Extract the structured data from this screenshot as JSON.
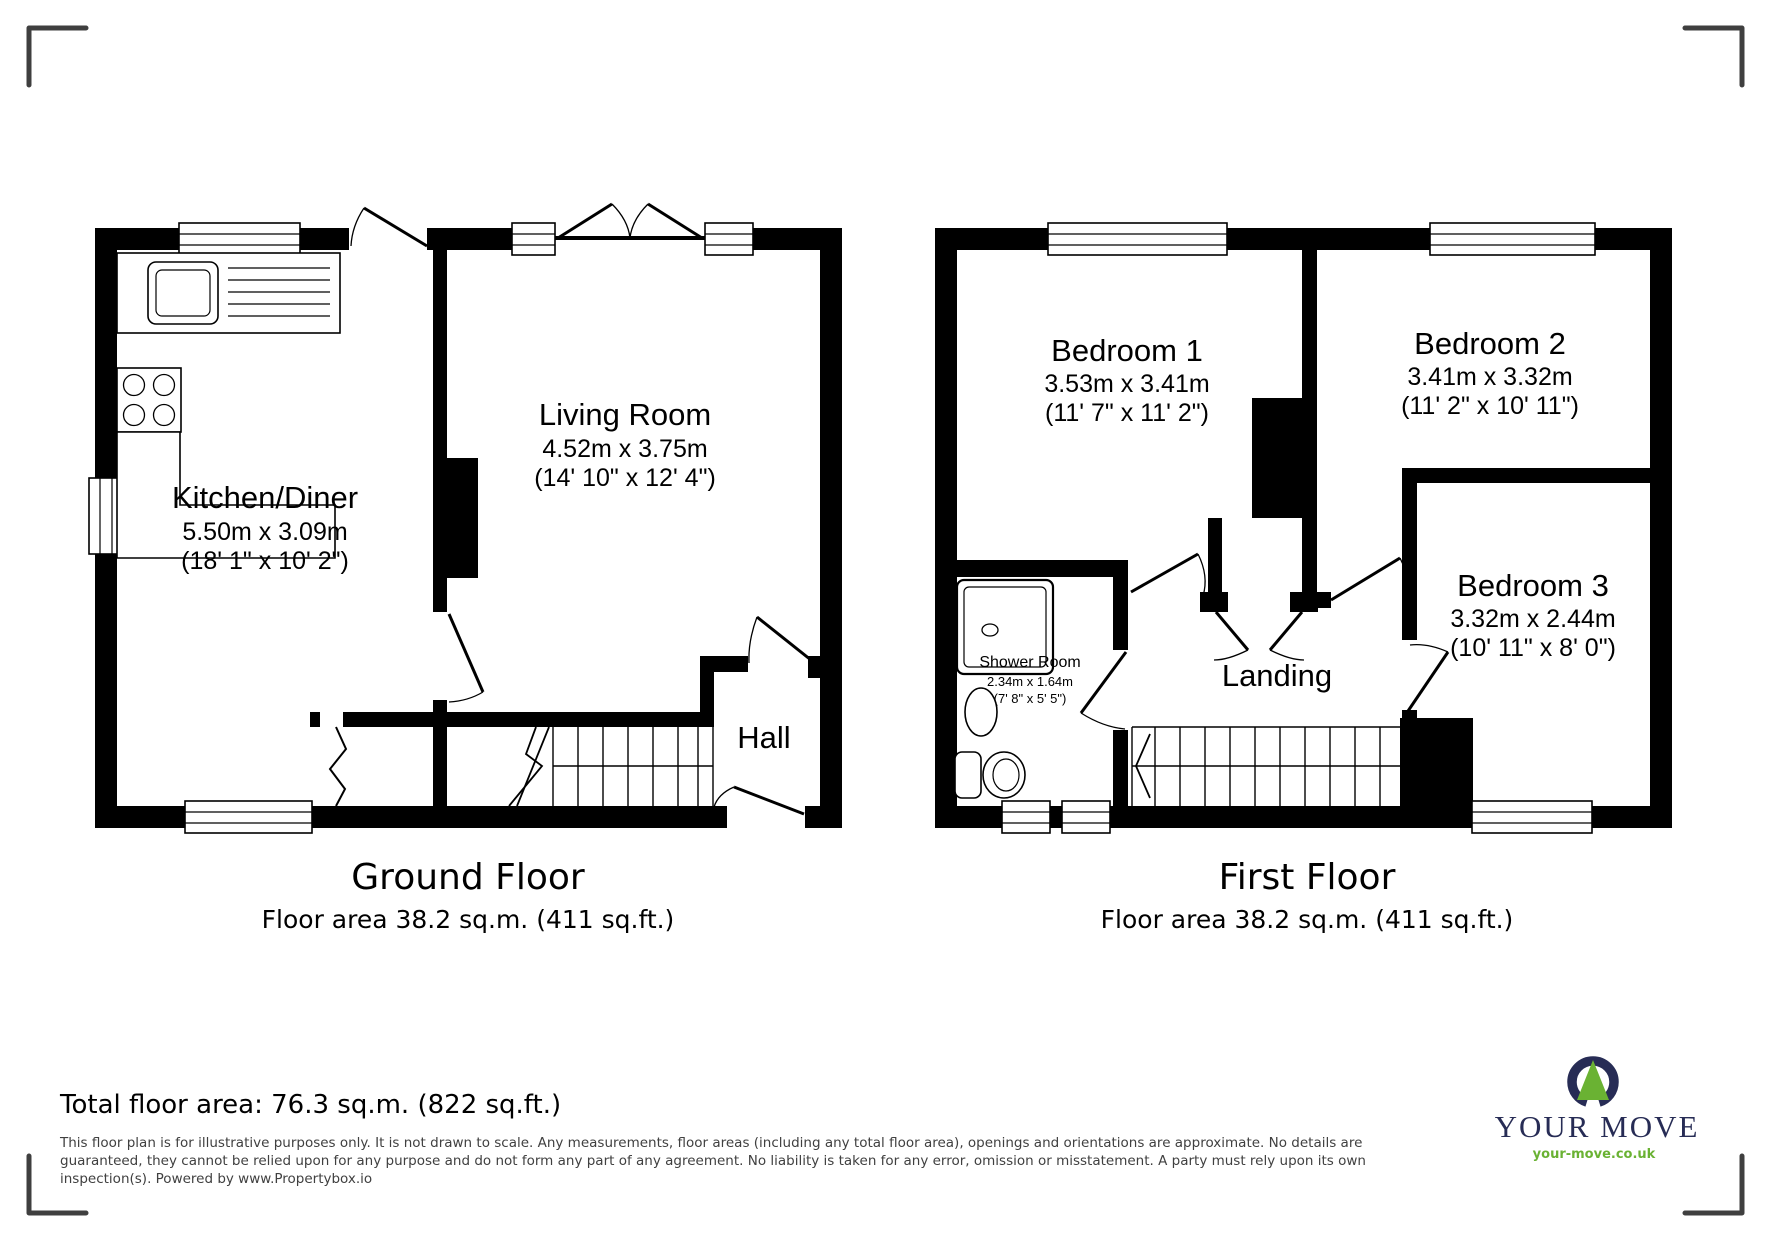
{
  "ground_floor": {
    "title": "Ground Floor",
    "area": "Floor area 38.2 sq.m. (411 sq.ft.)",
    "rooms": {
      "kitchen": {
        "name": "Kitchen/Diner",
        "metric": "5.50m x 3.09m",
        "imperial": "(18' 1\" x 10' 2\")"
      },
      "living": {
        "name": "Living Room",
        "metric": "4.52m x 3.75m",
        "imperial": "(14' 10\" x 12' 4\")"
      },
      "hall": {
        "name": "Hall"
      }
    }
  },
  "first_floor": {
    "title": "First Floor",
    "area": "Floor area 38.2 sq.m. (411 sq.ft.)",
    "rooms": {
      "bedroom1": {
        "name": "Bedroom 1",
        "metric": "3.53m x 3.41m",
        "imperial": "(11' 7\" x 11' 2\")"
      },
      "bedroom2": {
        "name": "Bedroom 2",
        "metric": "3.41m x 3.32m",
        "imperial": "(11' 2\" x 10' 11\")"
      },
      "bedroom3": {
        "name": "Bedroom 3",
        "metric": "3.32m x 2.44m",
        "imperial": "(10' 11\" x 8' 0\")"
      },
      "shower": {
        "name": "Shower Room",
        "metric": "2.34m x 1.64m",
        "imperial": "(7' 8\" x 5' 5\")"
      },
      "landing": {
        "name": "Landing"
      }
    }
  },
  "footer": {
    "total": "Total floor area: 76.3 sq.m. (822 sq.ft.)",
    "disclaimer_lines": [
      "This floor plan is for illustrative purposes only. It is not drawn to scale. Any measurements, floor areas (including any total floor area), openings and orientations are approximate. No details are",
      "guaranteed, they cannot be relied upon for any purpose and do not form any part of any agreement. No liability is taken for any error, omission or misstatement. A party must rely upon its own",
      "inspection(s). Powered by www.Propertybox.io"
    ]
  },
  "logo": {
    "name": "YOUR MOVE",
    "url": "your-move.co.uk",
    "navy": "#272c55",
    "green": "#6ab233"
  }
}
